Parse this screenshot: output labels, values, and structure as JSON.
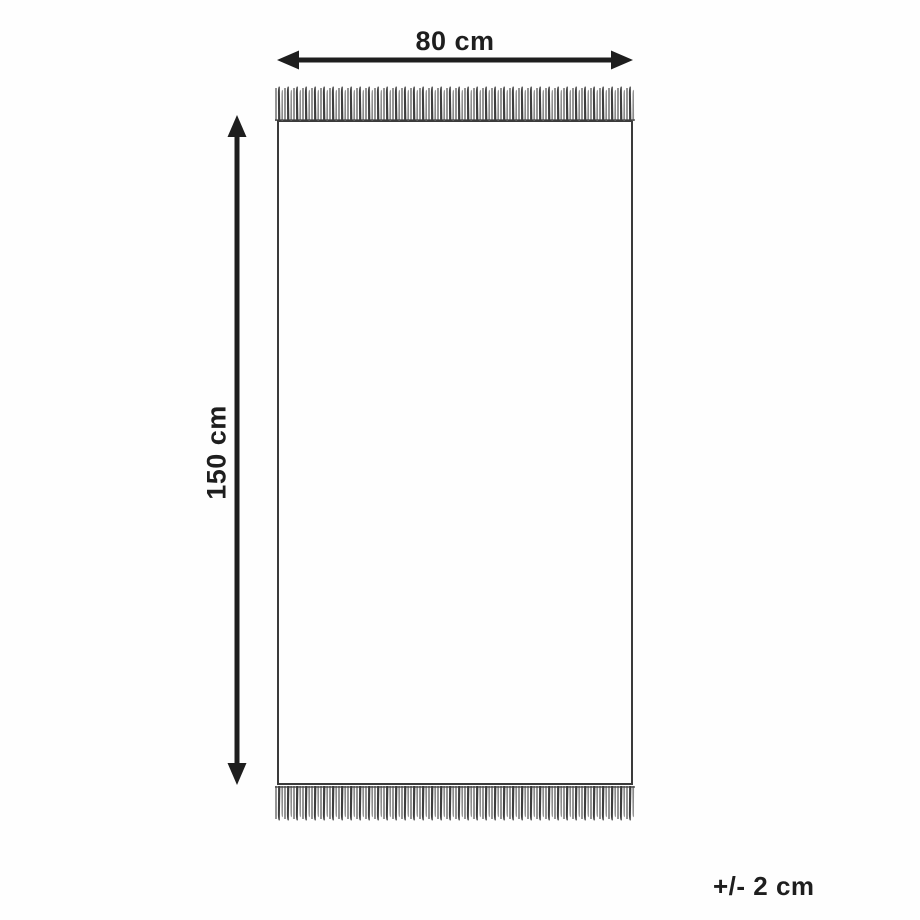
{
  "diagram": {
    "type": "product-dimension-diagram",
    "subject": "fringed rug",
    "width_label": "80 cm",
    "height_label": "150 cm",
    "tolerance_label": "+/- 2 cm"
  },
  "colors": {
    "line": "#1e1e1e",
    "rug_border": "#3a3a3a",
    "fringe_dark": "#3d3d3d",
    "fringe_light": "#8a8a8a",
    "background": "#fefefe"
  }
}
